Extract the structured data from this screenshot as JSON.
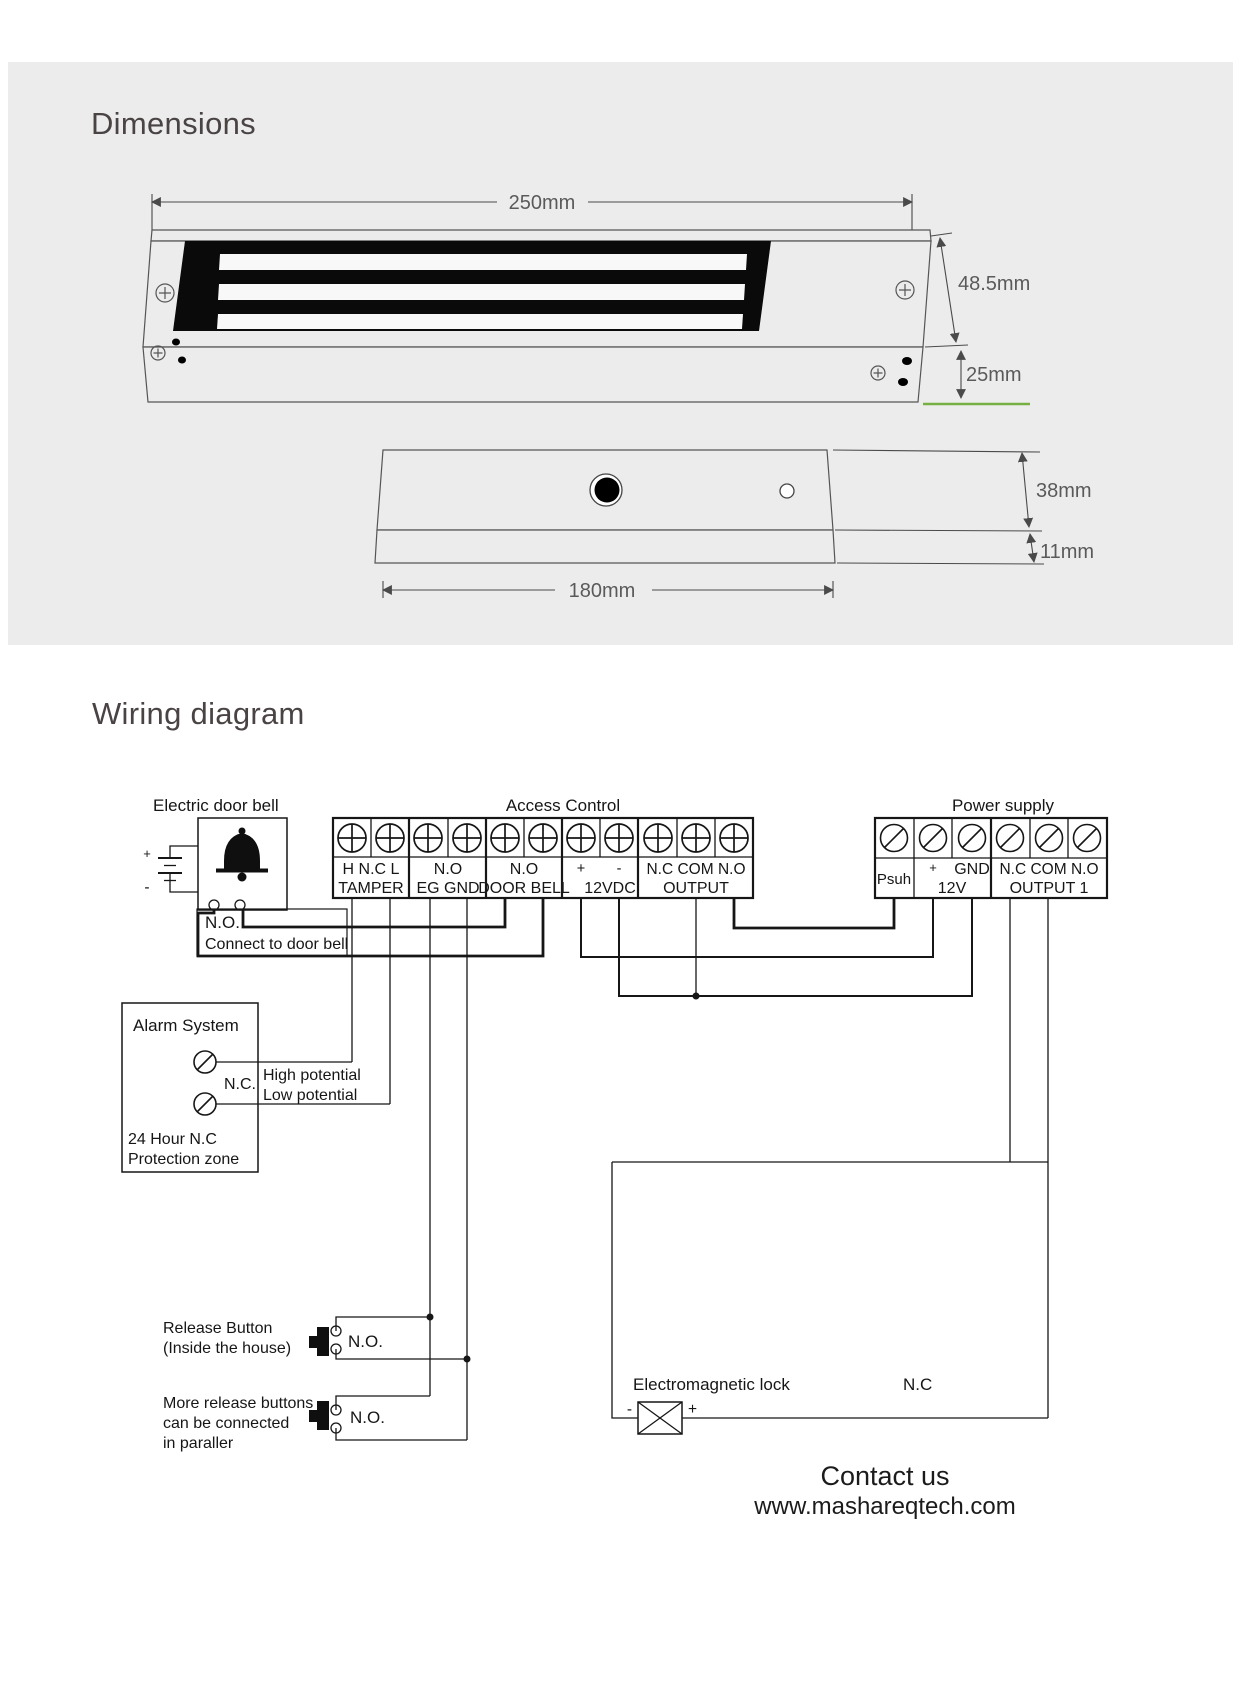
{
  "dimensions": {
    "title": "Dimensions",
    "lock_width": "250mm",
    "lock_height": "48.5mm",
    "lock_depth": "25mm",
    "plate_length": "180mm",
    "plate_width": "38mm",
    "plate_thickness": "11mm"
  },
  "wiring": {
    "title": "Wiring diagram",
    "door_bell": {
      "title": "Electric door bell",
      "plus": "+",
      "minus": "-",
      "no_label": "N.O.",
      "note": "Connect to door bell"
    },
    "access_control": {
      "title": "Access Control",
      "groups": [
        {
          "line1": "H N.C L",
          "line2": "TAMPER"
        },
        {
          "line1": "N.O",
          "line2": "EG GND"
        },
        {
          "line1": "N.O",
          "line2": "DOOR BELL"
        },
        {
          "plus": "+",
          "minus": "-",
          "line2": "12VDC"
        },
        {
          "line1": "N.C COM N.O",
          "line2": "OUTPUT"
        }
      ]
    },
    "power_supply": {
      "title": "Power supply",
      "push": "Psuh",
      "plus": "+",
      "gnd": "GND",
      "twelve_v": "12V",
      "line1": "N.C COM N.O",
      "line2": "OUTPUT 1"
    },
    "alarm": {
      "title": "Alarm System",
      "nc": "N.C.",
      "high": "High potential",
      "low": "Low potential",
      "zone1": "24 Hour N.C",
      "zone2": "Protection zone"
    },
    "release_button": {
      "line1": "Release Button",
      "line2": "(Inside the house)",
      "no_label": "N.O."
    },
    "more_buttons": {
      "line1": "More release buttons",
      "line2": "can be connected",
      "line3": "in paraller",
      "no_label": "N.O."
    },
    "maglock": {
      "label": "Electromagnetic lock",
      "nc": "N.C",
      "minus": "-",
      "plus": "+"
    }
  },
  "footer": {
    "line1": "Contact us",
    "line2": "www.mashareqtech.com"
  },
  "colors": {
    "panel_bg": "#ececec",
    "line": "#161616",
    "dim_text": "#5a5a5a",
    "accent_green": "#76b043"
  }
}
